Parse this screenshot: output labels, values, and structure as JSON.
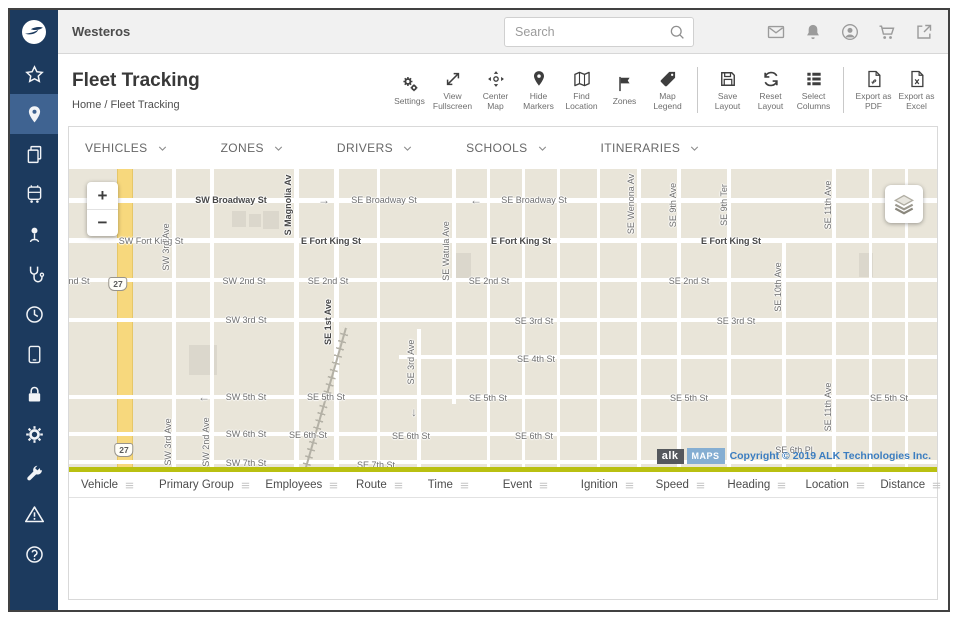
{
  "app": {
    "brand": "Westeros"
  },
  "topbar": {
    "search_placeholder": "Search",
    "icons": [
      "mail",
      "bell",
      "account",
      "cart",
      "external-link"
    ]
  },
  "sidebar": {
    "items": [
      {
        "icon": "star"
      },
      {
        "icon": "location-pin",
        "active": true
      },
      {
        "icon": "documents"
      },
      {
        "icon": "transit"
      },
      {
        "icon": "person-marker"
      },
      {
        "icon": "stethoscope"
      },
      {
        "icon": "clock"
      },
      {
        "icon": "tablet"
      },
      {
        "icon": "lock"
      },
      {
        "icon": "gear"
      },
      {
        "icon": "wrench"
      },
      {
        "icon": "warning"
      },
      {
        "icon": "help"
      }
    ]
  },
  "page": {
    "title": "Fleet Tracking",
    "breadcrumb": "Home / Fleet Tracking"
  },
  "toolbar": {
    "groups": [
      {
        "items": [
          {
            "label": "Settings",
            "icon": "settings"
          },
          {
            "label": "View Fullscreen",
            "icon": "fullscreen"
          },
          {
            "label": "Center Map",
            "icon": "center-map"
          },
          {
            "label": "Hide Markers",
            "icon": "marker"
          },
          {
            "label": "Find Location",
            "icon": "map-fold"
          },
          {
            "label": "Zones",
            "icon": "flag"
          },
          {
            "label": "Map Legend",
            "icon": "tag"
          }
        ]
      },
      {
        "items": [
          {
            "label": "Save Layout",
            "icon": "save"
          },
          {
            "label": "Reset Layout",
            "icon": "reset"
          },
          {
            "label": "Select Columns",
            "icon": "columns"
          }
        ]
      },
      {
        "items": [
          {
            "label": "Export as PDF",
            "icon": "pdf"
          },
          {
            "label": "Export as Excel",
            "icon": "excel"
          }
        ]
      }
    ]
  },
  "filters": [
    {
      "label": "VEHICLES"
    },
    {
      "label": "ZONES"
    },
    {
      "label": "DRIVERS"
    },
    {
      "label": "SCHOOLS"
    },
    {
      "label": "ITINERARIES"
    }
  ],
  "map": {
    "zoom_in": "+",
    "zoom_out": "−",
    "attribution": {
      "alk": "alk",
      "maps": "MAPS",
      "text": "Copyright © 2019 ALK Technologies Inc."
    },
    "highway": {
      "x": 48,
      "width": 16,
      "shields": [
        {
          "label": "27",
          "x": 49,
          "y": 115
        },
        {
          "label": "27",
          "x": 55,
          "y": 281
        }
      ]
    },
    "railroad": {
      "x": 252,
      "y": 156,
      "h": 152,
      "angle": 16
    },
    "buildings": [
      {
        "x": 163,
        "y": 42,
        "w": 14,
        "h": 16
      },
      {
        "x": 180,
        "y": 45,
        "w": 12,
        "h": 13
      },
      {
        "x": 194,
        "y": 42,
        "w": 16,
        "h": 18
      },
      {
        "x": 386,
        "y": 84,
        "w": 16,
        "h": 28
      },
      {
        "x": 120,
        "y": 176,
        "w": 28,
        "h": 30
      },
      {
        "x": 790,
        "y": 84,
        "w": 14,
        "h": 24
      }
    ],
    "h_lines": [
      {
        "y": 29,
        "w": 5
      },
      {
        "y": 69,
        "w": 5
      },
      {
        "y": 109,
        "w": 4
      },
      {
        "y": 149,
        "w": 4
      },
      {
        "y": 186,
        "w": 4,
        "x1": 330
      },
      {
        "y": 226,
        "w": 4
      },
      {
        "y": 263,
        "w": 4
      },
      {
        "y": 291,
        "w": 4
      }
    ],
    "v_lines": [
      {
        "x": 103,
        "w": 4
      },
      {
        "x": 141,
        "w": 4
      },
      {
        "x": 225,
        "w": 5
      },
      {
        "x": 265,
        "w": 5
      },
      {
        "x": 308,
        "w": 3
      },
      {
        "x": 348,
        "w": 4,
        "y1": 160
      },
      {
        "x": 383,
        "w": 4,
        "y2": 235
      },
      {
        "x": 418,
        "w": 3
      },
      {
        "x": 453,
        "w": 3
      },
      {
        "x": 488,
        "w": 3
      },
      {
        "x": 528,
        "w": 3
      },
      {
        "x": 568,
        "w": 4
      },
      {
        "x": 608,
        "w": 4
      },
      {
        "x": 658,
        "w": 4
      },
      {
        "x": 713,
        "w": 4,
        "y1": 72
      },
      {
        "x": 763,
        "w": 4
      },
      {
        "x": 800,
        "w": 3
      },
      {
        "x": 836,
        "w": 3
      }
    ],
    "labels": [
      {
        "t": "SW Broadway St",
        "x": 162,
        "y": 31,
        "b": 1
      },
      {
        "t": "→",
        "x": 255,
        "y": 31,
        "a": 1
      },
      {
        "t": "SE Broadway St",
        "x": 315,
        "y": 31
      },
      {
        "t": "←",
        "x": 407,
        "y": 31,
        "a": 1
      },
      {
        "t": "SE Broadway St",
        "x": 465,
        "y": 31
      },
      {
        "t": "SW Fort King St",
        "x": 82,
        "y": 72
      },
      {
        "t": "E Fort King St",
        "x": 262,
        "y": 72,
        "b": 1
      },
      {
        "t": "E Fort King St",
        "x": 452,
        "y": 72,
        "b": 1
      },
      {
        "t": "E Fort King St",
        "x": 662,
        "y": 72,
        "b": 1
      },
      {
        "t": "nd St",
        "x": 10,
        "y": 112
      },
      {
        "t": "SW 2nd St",
        "x": 175,
        "y": 112
      },
      {
        "t": "SE 2nd St",
        "x": 259,
        "y": 112
      },
      {
        "t": "SE 2nd St",
        "x": 420,
        "y": 112
      },
      {
        "t": "SE 2nd St",
        "x": 620,
        "y": 112
      },
      {
        "t": "SW 3rd St",
        "x": 177,
        "y": 151
      },
      {
        "t": "SE 3rd St",
        "x": 465,
        "y": 152
      },
      {
        "t": "SE 3rd St",
        "x": 667,
        "y": 152
      },
      {
        "t": "SE 4th St",
        "x": 467,
        "y": 190
      },
      {
        "t": "←",
        "x": 135,
        "y": 228,
        "a": 1
      },
      {
        "t": "SW 5th St",
        "x": 177,
        "y": 228
      },
      {
        "t": "SE 5th St",
        "x": 257,
        "y": 228
      },
      {
        "t": "SE 5th St",
        "x": 419,
        "y": 229
      },
      {
        "t": "SE 5th St",
        "x": 620,
        "y": 229
      },
      {
        "t": "SE 5th St",
        "x": 820,
        "y": 229
      },
      {
        "t": "SW 6th St",
        "x": 177,
        "y": 265
      },
      {
        "t": "SE 6th St",
        "x": 239,
        "y": 266
      },
      {
        "t": "SE 6th St",
        "x": 342,
        "y": 267
      },
      {
        "t": "SE 6th St",
        "x": 465,
        "y": 267
      },
      {
        "t": "SE 6th Pl",
        "x": 725,
        "y": 281
      },
      {
        "t": "SW 7th St",
        "x": 177,
        "y": 294
      },
      {
        "t": "SE 7th St",
        "x": 307,
        "y": 296
      },
      {
        "t": "SW 3rd Ave",
        "x": 97,
        "y": 78,
        "r": 1
      },
      {
        "t": "SW 3rd Ave",
        "x": 99,
        "y": 273,
        "r": 1
      },
      {
        "t": "SW 2nd Ave",
        "x": 137,
        "y": 273,
        "r": 1
      },
      {
        "t": "S Magnolia Av",
        "x": 219,
        "y": 36,
        "r": 1,
        "b": 1
      },
      {
        "t": "SE 1st Ave",
        "x": 259,
        "y": 153,
        "r": 1,
        "b": 1
      },
      {
        "t": "SE Watula Ave",
        "x": 377,
        "y": 82,
        "r": 1
      },
      {
        "t": "SE 3rd Ave",
        "x": 342,
        "y": 193,
        "r": 1
      },
      {
        "t": "↓",
        "x": 345,
        "y": 243,
        "a": 1
      },
      {
        "t": "SE Wenona Av",
        "x": 562,
        "y": 35,
        "r": 1
      },
      {
        "t": "SE 9th Ave",
        "x": 604,
        "y": 36,
        "r": 1
      },
      {
        "t": "SE 9th Ter",
        "x": 655,
        "y": 36,
        "r": 1
      },
      {
        "t": "SE 10th Ave",
        "x": 709,
        "y": 118,
        "r": 1
      },
      {
        "t": "SE 11th Ave",
        "x": 759,
        "y": 36,
        "r": 1
      },
      {
        "t": "SE 11th Ave",
        "x": 759,
        "y": 238,
        "r": 1
      }
    ]
  },
  "table": {
    "columns": [
      "Vehicle",
      "Primary Group",
      "Employees",
      "Route",
      "Time",
      "Event",
      "Ignition",
      "Speed",
      "Heading",
      "Location",
      "Distance"
    ],
    "flex": [
      1.05,
      1.5,
      1.25,
      0.95,
      1.0,
      1.05,
      1.0,
      0.95,
      1.05,
      1.0,
      0.9
    ]
  },
  "colors": {
    "navy": "#1c3a5e",
    "active_navy": "#3f6391",
    "olive": "#b9c011",
    "copyright_blue": "#3b7dc0",
    "highway_yellow": "#f7d87d"
  }
}
